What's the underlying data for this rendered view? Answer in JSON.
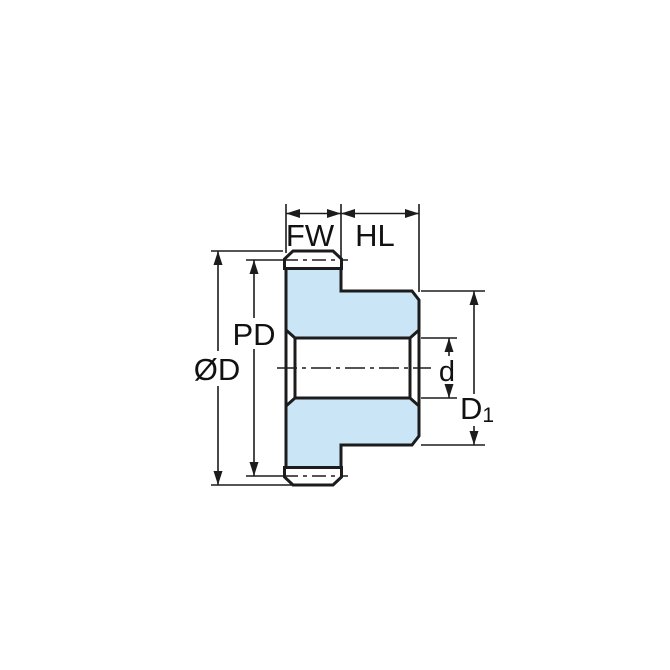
{
  "diagram": {
    "type": "technical-drawing",
    "subject": "spur gear side cross-section with dimension callouts",
    "labels": {
      "face_width": "FW",
      "hub_length": "HL",
      "pitch_diameter": "PD",
      "outside_diameter": "ØD",
      "bore_diameter": "d",
      "hub_diameter_base": "D",
      "hub_diameter_subscript": "1"
    },
    "colors": {
      "part_fill": "#c9e5f6",
      "line_color": "#1c1c1c",
      "background": "#ffffff"
    }
  }
}
